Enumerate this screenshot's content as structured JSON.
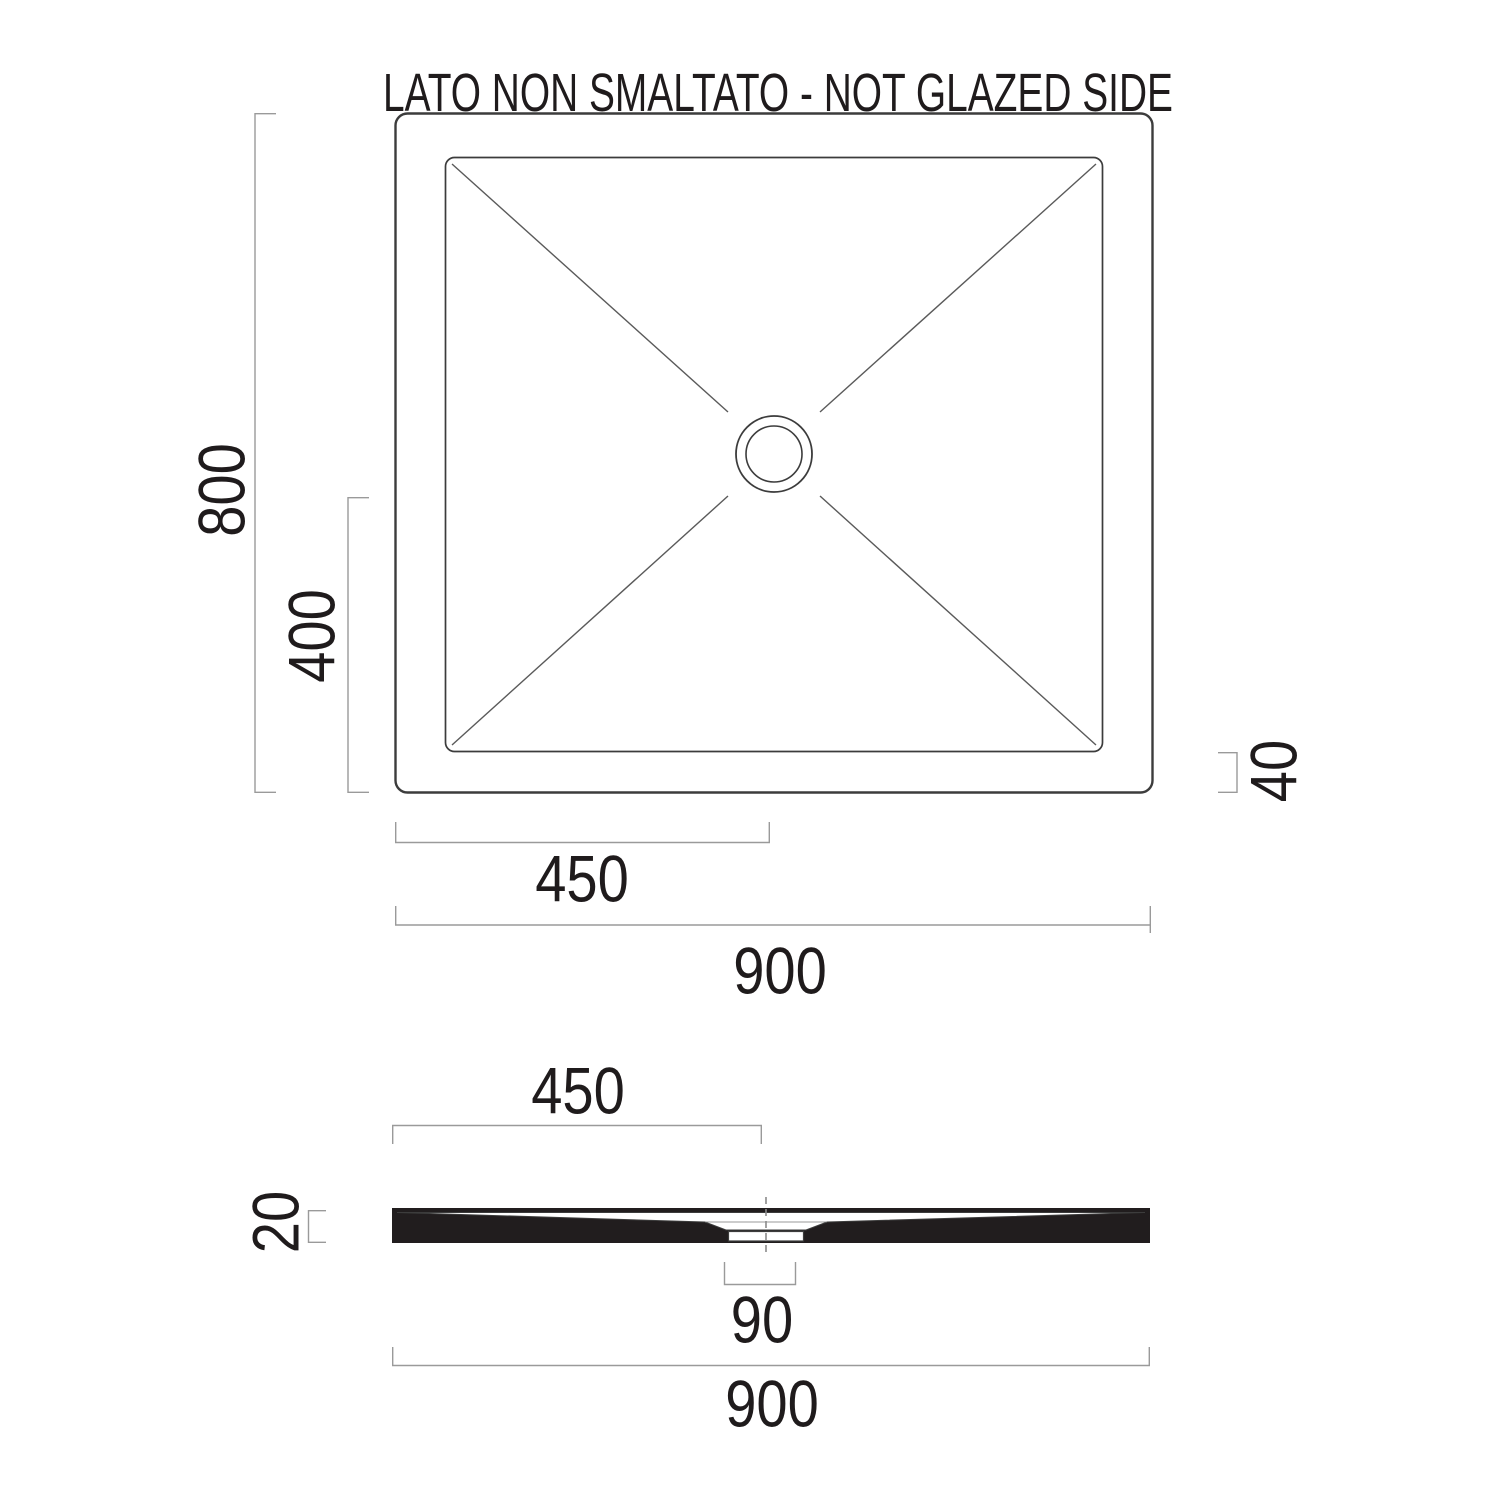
{
  "title": "LATO NON SMALTATO - NOT GLAZED SIDE",
  "colors": {
    "background": "#ffffff",
    "drawing_line": "#3c3c3c",
    "dimension_line": "#9a9a9a",
    "text": "#1f1b1c",
    "section_fill": "#211d1e"
  },
  "top_view": {
    "dim_height": "800",
    "dim_half_height": "400",
    "dim_edge_offset": "40",
    "dim_center_offset": "450",
    "dim_width": "900"
  },
  "section_view": {
    "dim_center_offset": "450",
    "dim_thickness": "20",
    "dim_drain_width": "90",
    "dim_width": "900"
  }
}
